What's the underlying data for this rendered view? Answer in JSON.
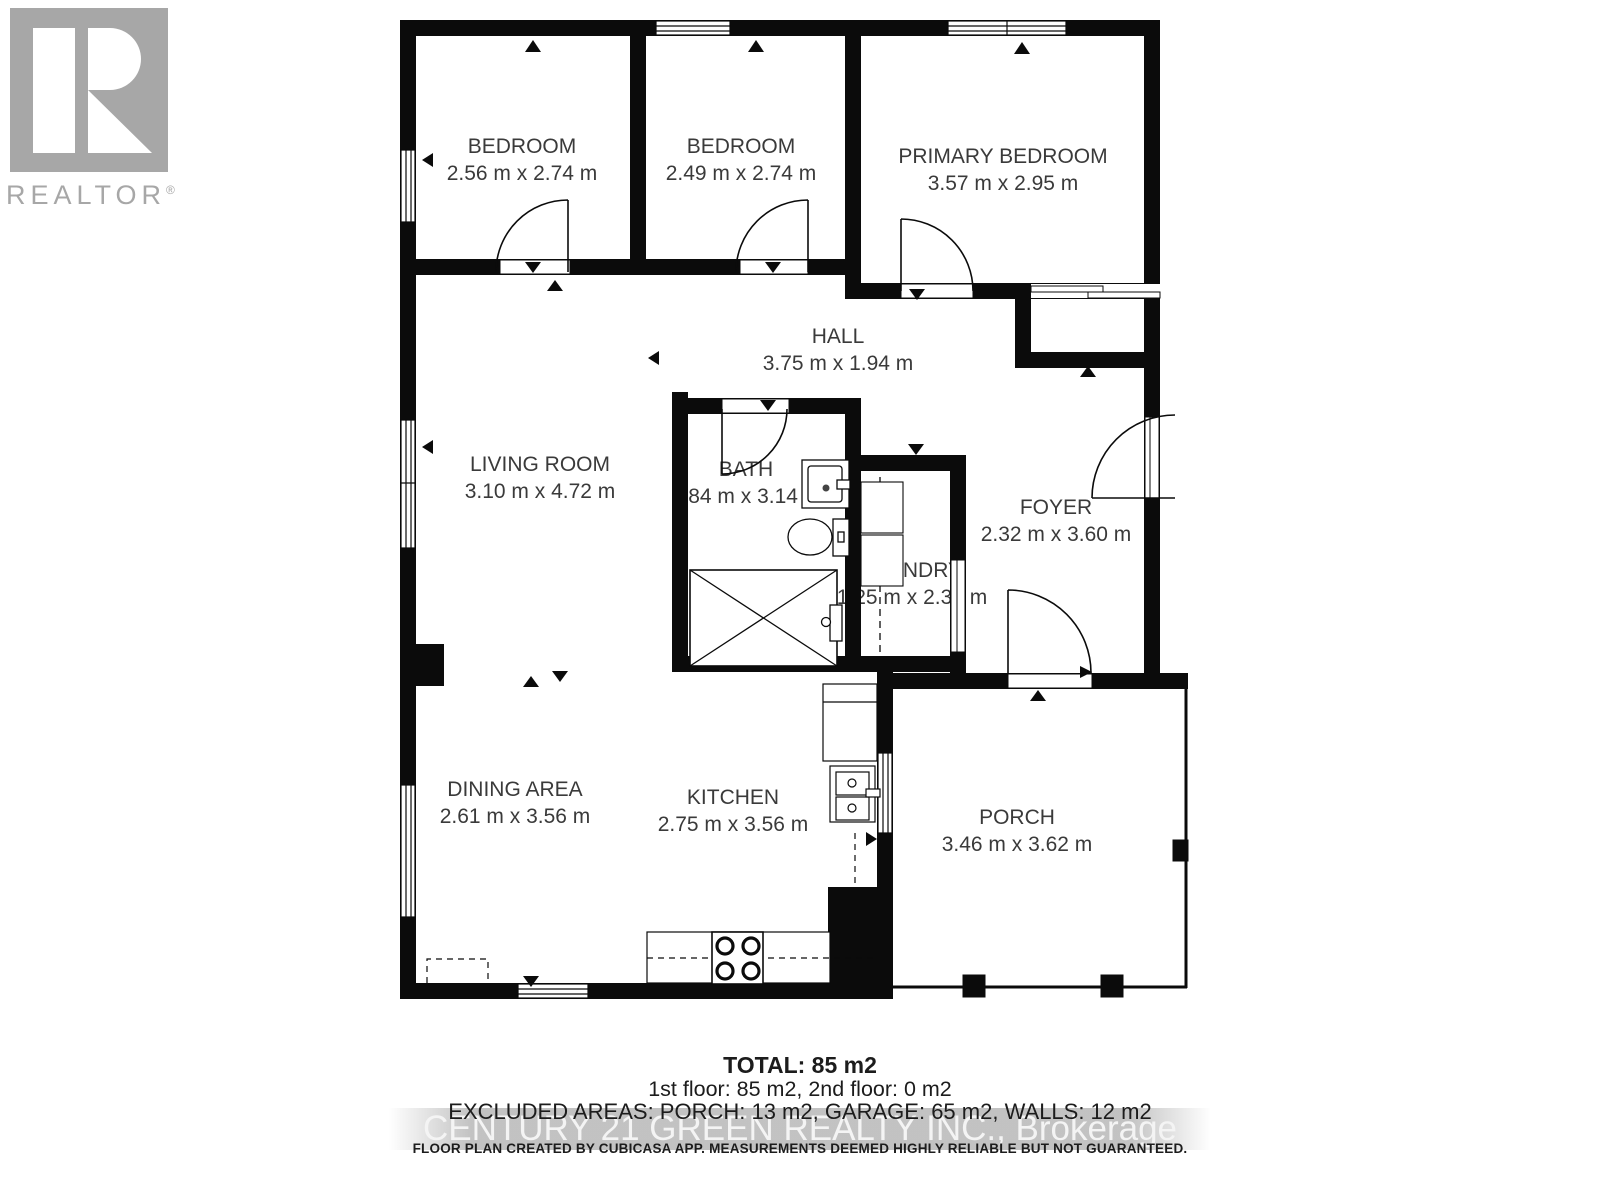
{
  "logo": {
    "brand": "REALTOR",
    "registered": "®"
  },
  "rooms": {
    "bedroom1": {
      "name": "BEDROOM",
      "dims": "2.56 m x 2.74 m"
    },
    "bedroom2": {
      "name": "BEDROOM",
      "dims": "2.49 m x 2.74 m"
    },
    "primary": {
      "name": "PRIMARY BEDROOM",
      "dims": "3.57 m x 2.95 m"
    },
    "hall": {
      "name": "HALL",
      "dims": "3.75 m x 1.94 m"
    },
    "living": {
      "name": "LIVING ROOM",
      "dims": "3.10 m x 4.72 m"
    },
    "bath": {
      "name": "BATH",
      "dims": "1.84 m x 3.14 m"
    },
    "laundry": {
      "name": "LAUNDRY",
      "dims": "1.25 m x 2.36 m"
    },
    "foyer": {
      "name": "FOYER",
      "dims": "2.32 m x 3.60 m"
    },
    "dining": {
      "name": "DINING AREA",
      "dims": "2.61 m x 3.56 m"
    },
    "kitchen": {
      "name": "KITCHEN",
      "dims": "2.75 m x 3.56 m"
    },
    "porch": {
      "name": "PORCH",
      "dims": "3.46 m x 3.62 m"
    }
  },
  "footer": {
    "total": "TOTAL: 85 m2",
    "floors": "1st floor: 85 m2, 2nd floor: 0 m2",
    "excluded": "EXCLUDED AREAS: PORCH: 13 m2, GARAGE: 65 m2, WALLS: 12 m2",
    "watermark": "CENTURY 21 GREEN REALTY INC., Brokerage",
    "disclaimer": "FLOOR PLAN CREATED BY CUBICASA APP. MEASUREMENTS DEEMED HIGHLY RELIABLE BUT NOT GUARANTEED."
  },
  "colors": {
    "wall": "#0b0b0b",
    "label_text": "#3a3a3a",
    "logo_gray": "#a7a7a7",
    "watermark_band": "#b8b8b8"
  }
}
